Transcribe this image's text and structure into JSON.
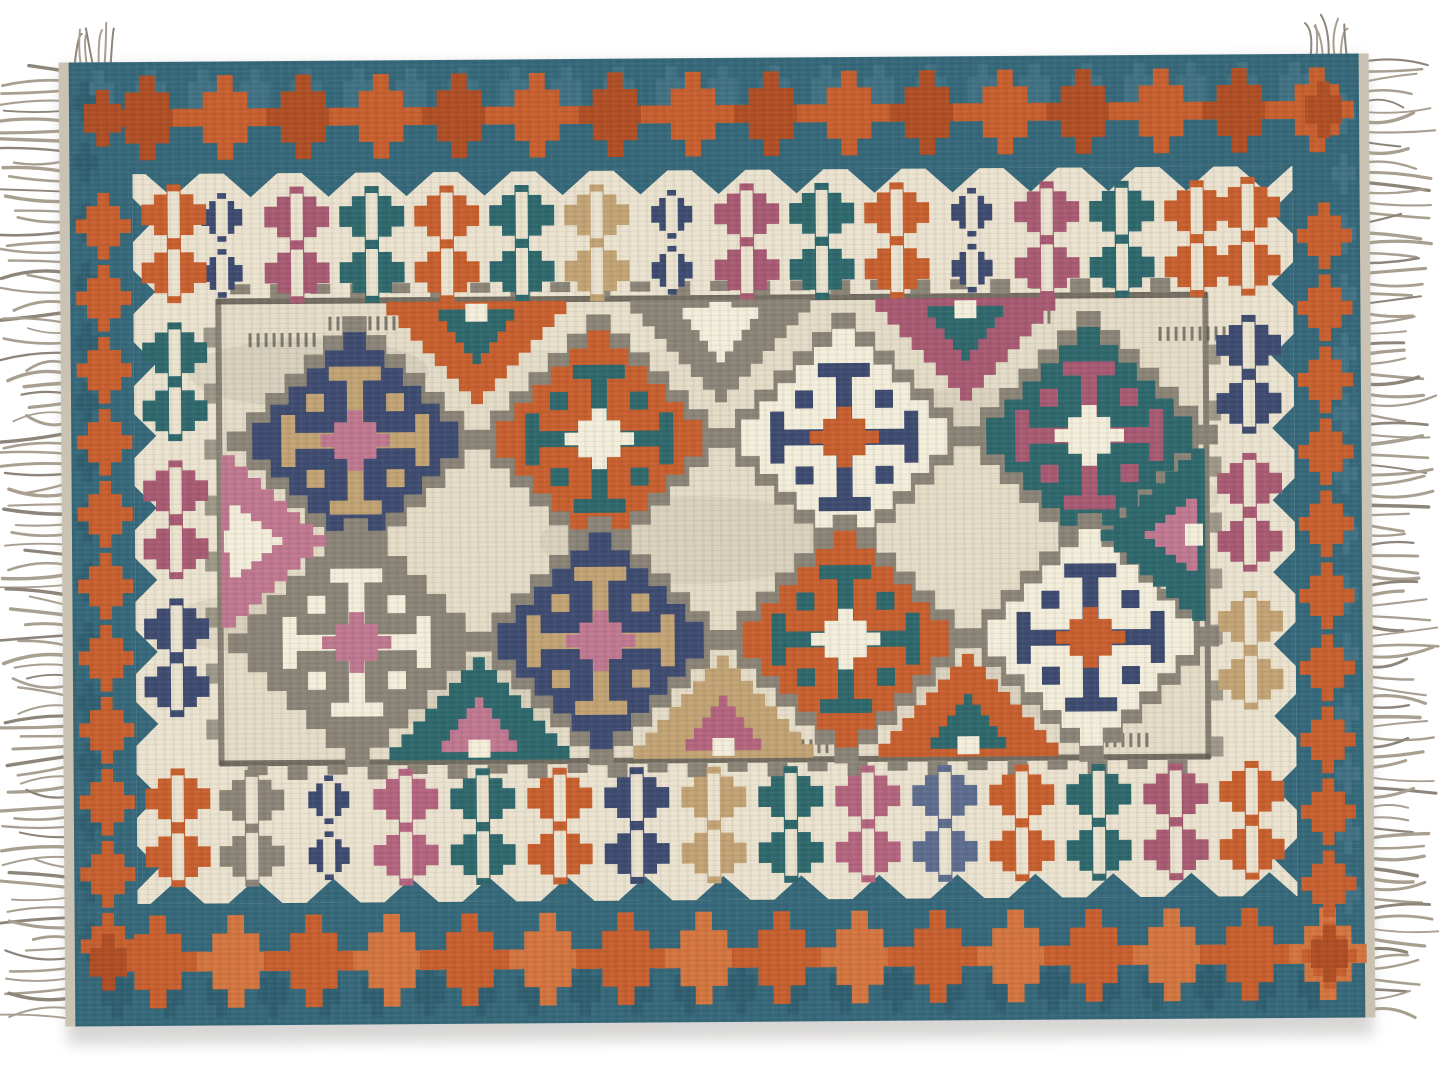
{
  "scene": {
    "subject": "flat-lay-photo-of-handwoven-kilim-area-rug",
    "background": "#ffffff",
    "orientation": "landscape"
  },
  "canvas": {
    "width": 1445,
    "height": 1084
  },
  "palette": {
    "teal_band": "#35687a",
    "teal_band_dark": "#2a5867",
    "teal_band_light": "#4b7d8e",
    "orange": "#c85f2e",
    "orange_dark": "#b04e24",
    "orange_light": "#d4753f",
    "cream": "#ebe3cf",
    "cream_dark": "#d9d0ba",
    "field": "#e4dcc7",
    "gray": "#8b8477",
    "gray_dark": "#5e584e",
    "gray_motif": "#6f695e",
    "navy": "#3e4b70",
    "steel": "#5e6c8e",
    "teal": "#2e686c",
    "mauve": "#a85a72",
    "pink": "#b4647e",
    "rose": "#c07890",
    "tan": "#c2a374",
    "white": "#f4eedb",
    "fringe": "#a89f90",
    "fringe_dark": "#8e857a",
    "selvedge": "#cac2b2",
    "shadow": "#3c372d"
  },
  "rug": {
    "x": 72,
    "y": 58,
    "width": 1290,
    "height": 964,
    "rotation_deg": -0.4,
    "bands": {
      "teal_top": 112,
      "teal_bottom": 122,
      "teal_left": 63,
      "teal_right": 67,
      "cream_top": 130,
      "cream_bottom": 142,
      "cream_left": 87,
      "cream_right": 90
    }
  },
  "border_chain": {
    "motif": "stepped-cross-diamond",
    "color": "orange",
    "top_count": 16,
    "bottom_count": 16,
    "left_count": 11,
    "right_count": 11
  },
  "cream_band_motifs": {
    "motif": "stepped-diamond-with-slot",
    "slot_color": "cream",
    "top": [
      "navy_small",
      "mauve",
      "teal",
      "orange",
      "teal",
      "tan",
      "navy_small",
      "mauve",
      "teal",
      "orange",
      "navy_small",
      "mauve",
      "teal",
      "orange"
    ],
    "bottom": [
      "gray",
      "navy_small",
      "pink",
      "teal",
      "orange",
      "navy",
      "tan",
      "teal",
      "pink",
      "steel",
      "orange",
      "teal",
      "mauve"
    ],
    "left": [
      "orange",
      "teal",
      "mauve",
      "navy",
      "orange"
    ],
    "right": [
      "orange",
      "navy",
      "mauve",
      "tan",
      "orange"
    ]
  },
  "field": {
    "ground": "field",
    "lattice": "gray",
    "medallions": [
      {
        "cx": 356,
        "cy": 438,
        "body": "navy",
        "cross": "tan",
        "center": "rose"
      },
      {
        "cx": 600,
        "cy": 438,
        "body": "orange",
        "cross": "teal",
        "center": "white"
      },
      {
        "cx": 845,
        "cy": 438,
        "body": "white",
        "cross": "navy",
        "center": "orange"
      },
      {
        "cx": 1090,
        "cy": 438,
        "body": "teal",
        "cross": "mauve",
        "center": "white"
      },
      {
        "cx": 356,
        "cy": 640,
        "body": "gray",
        "cross": "white",
        "center": "rose"
      },
      {
        "cx": 600,
        "cy": 640,
        "body": "navy",
        "cross": "tan",
        "center": "rose"
      },
      {
        "cx": 845,
        "cy": 640,
        "body": "orange",
        "cross": "teal",
        "center": "white"
      },
      {
        "cx": 1090,
        "cy": 640,
        "body": "white",
        "cross": "navy",
        "center": "orange"
      }
    ],
    "top_triangles": [
      {
        "x": 478,
        "color": "orange",
        "inner": "teal"
      },
      {
        "x": 722,
        "color": "gray",
        "inner": "white"
      },
      {
        "x": 967,
        "color": "mauve",
        "inner": "teal"
      }
    ],
    "bottom_triangles": [
      {
        "x": 478,
        "color": "teal",
        "inner": "rose"
      },
      {
        "x": 722,
        "color": "tan",
        "inner": "pink"
      },
      {
        "x": 967,
        "color": "orange",
        "inner": "teal"
      }
    ],
    "side_triangles": [
      {
        "side": "left",
        "y": 538,
        "color": "rose",
        "inner": "white"
      },
      {
        "side": "right",
        "y": 538,
        "color": "teal",
        "inner": "rose"
      }
    ]
  },
  "fringe": {
    "sides": [
      "left",
      "right"
    ],
    "strands_per_side": 95,
    "length_px": 52
  }
}
